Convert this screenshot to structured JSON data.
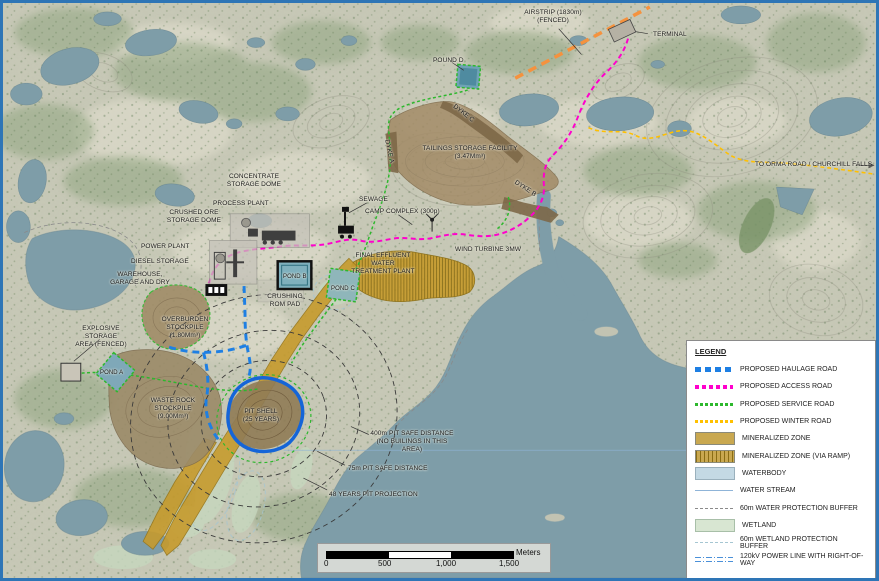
{
  "map": {
    "labels": {
      "airstrip": "AIRSTRIP (1830m)\n(FENCED)",
      "terminal": "TERMINAL",
      "pound_d": "POUND D",
      "tailings": "TAILINGS STORAGE FACILITY\n(3.47Mm³)",
      "dyke_a": "DYKE A",
      "dyke_b": "DYKE B",
      "dyke_c": "DYKE C",
      "orma": "TO ORMA ROAD / CHURCHILL FALLS",
      "sewage": "SEWAGE",
      "camp": "CAMP COMPLEX (300p)",
      "wind": "WIND TURBINE 3MW",
      "effluent": "FINAL EFFLUENT WATER\nTREATMENT PLANT",
      "concentrate": "CONCENTRATE\nSTORAGE DOME",
      "process": "PROCESS PLANT",
      "crushed_ore": "CRUSHED ORE\nSTORAGE DOME",
      "power_plant": "POWER PLANT",
      "diesel": "DIESEL STORAGE",
      "warehouse": "WAREHOUSE,\nGARAGE AND DRY",
      "pond_b": "POND B",
      "pond_c": "POND C",
      "crushing": "CRUSHING\nROM PAD",
      "explosive": "EXPLOSIVE STORAGE\nAREA (FENCED)",
      "overburden": "OVERBURDEN\nSTOCKPILE\n(1.80Mm³)",
      "pond_a": "POND A",
      "waste_rock": "WASTE ROCK\nSTOCKPILE\n(9.00Mm³)",
      "pit_shell": "PIT SHELL\n(25 YEARS)",
      "d400": "400m PIT SAFE DISTANCE\n(NO BUILINGS IN THIS AREA)",
      "d75": "75m PIT SAFE DISTANCE",
      "d48": "48 YEARS PIT PROJECTION"
    }
  },
  "legend": {
    "title": "LEGEND",
    "items": [
      {
        "label": "PROPOSED HAULAGE ROAD"
      },
      {
        "label": "PROPOSED ACCESS ROAD"
      },
      {
        "label": "PROPOSED SERVICE ROAD"
      },
      {
        "label": "PROPOSED WINTER ROAD"
      },
      {
        "label": "MINERALIZED ZONE"
      },
      {
        "label": "MINERALIZED ZONE (VIA RAMP)"
      },
      {
        "label": "WATERBODY"
      },
      {
        "label": "WATER STREAM"
      },
      {
        "label": "60m WATER PROTECTION BUFFER"
      },
      {
        "label": "WETLAND"
      },
      {
        "label": "60m WETLAND PROTECTION BUFFER"
      },
      {
        "label": "120kV POWER LINE WITH RIGHT-OF-WAY"
      }
    ]
  },
  "scalebar": {
    "ticks": [
      "0",
      "500",
      "1,000",
      "1,500"
    ],
    "unit": "Meters"
  },
  "colors": {
    "haulage_road": "#1e7fe3",
    "access_road": "#ff00cc",
    "service_road": "#2db82d",
    "winter_road": "#ffc000",
    "airstrip_line": "#f5923e",
    "mineralized": "#c69b2d",
    "waterbody": "#7e9da8",
    "wetland": "#c6d8bf",
    "tailings": "#a18a66",
    "pit_outline": "#1565d8",
    "power_line": "#4a90d9",
    "frame_border": "#2e75b6"
  }
}
